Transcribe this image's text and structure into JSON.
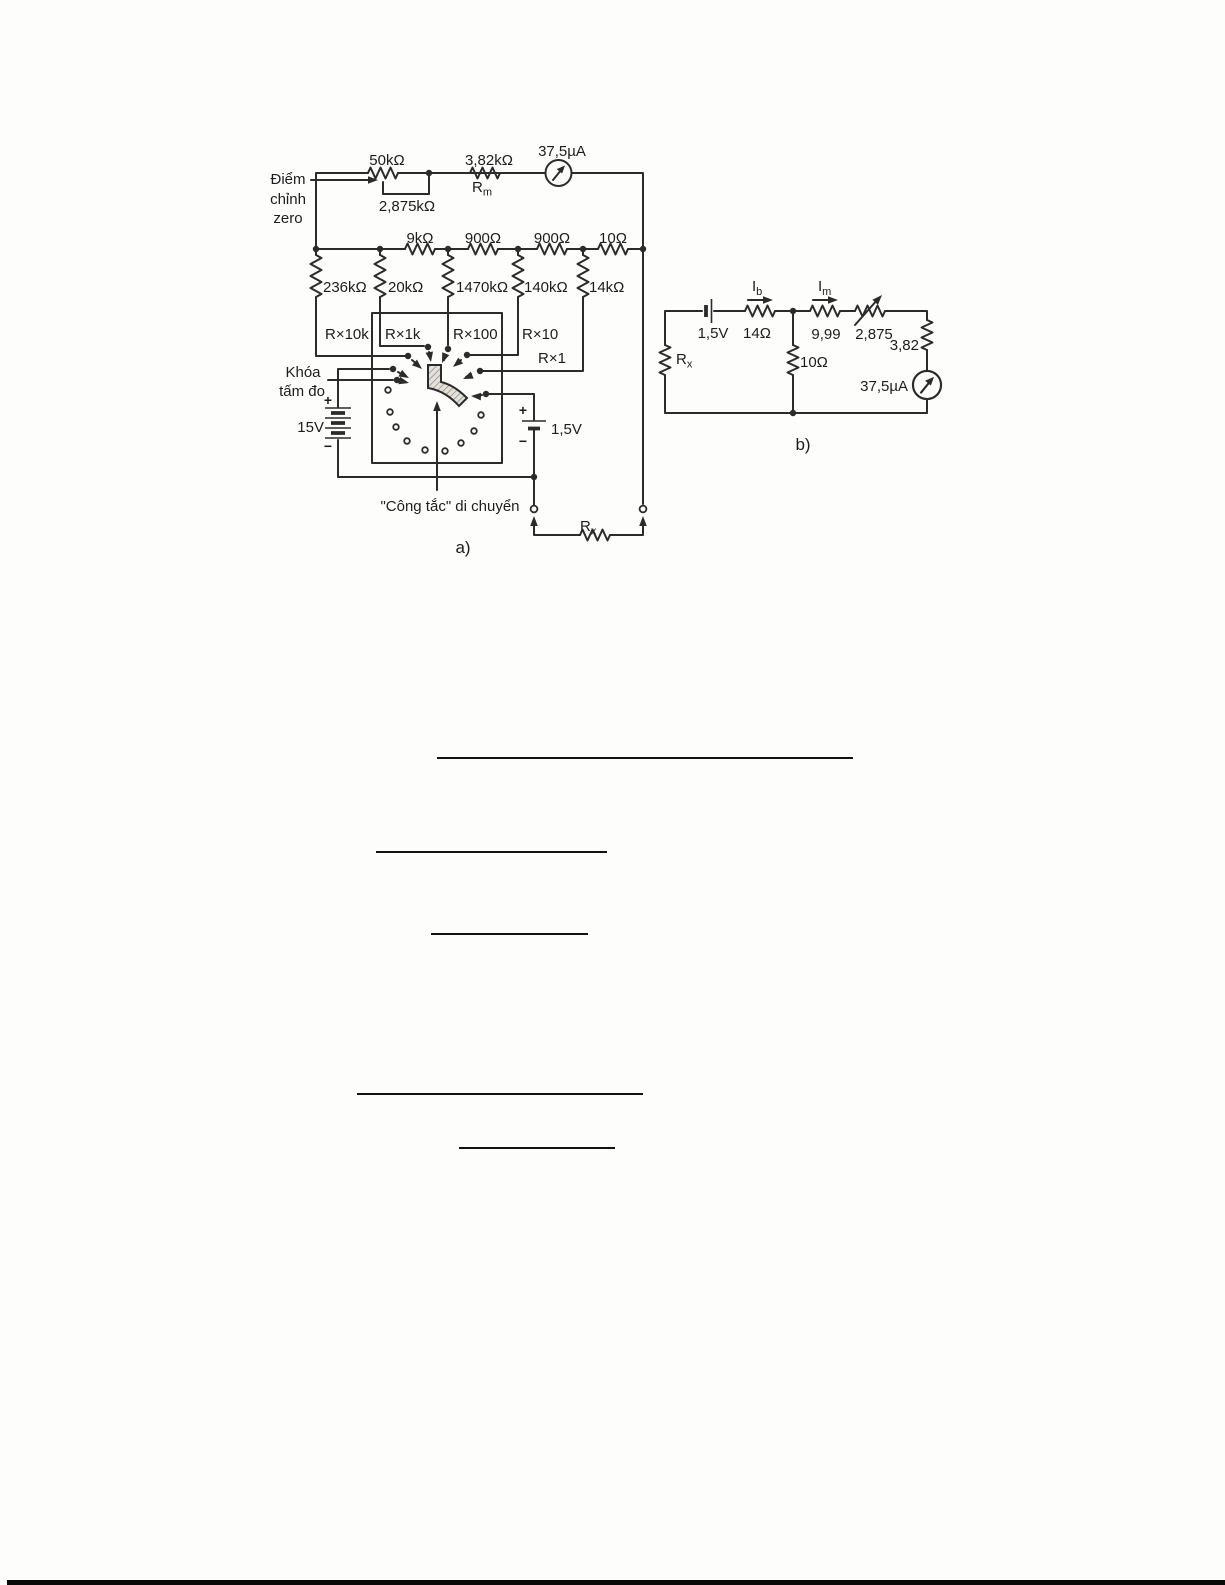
{
  "figure": {
    "circuit_a": {
      "caption": "a)",
      "zero_adjust": [
        "Điểm",
        "chỉnh",
        "zero"
      ],
      "pot": "50kΩ",
      "pot_shunt": "2,875kΩ",
      "rm_value": "3,82kΩ",
      "rm": {
        "base": "R",
        "sub": "m"
      },
      "meter": "37,5µA",
      "series": [
        "9kΩ",
        "900Ω",
        "900Ω",
        "10Ω"
      ],
      "shunts": [
        "236kΩ",
        "20kΩ",
        "1470kΩ",
        "140kΩ",
        "14kΩ"
      ],
      "ranges": [
        "R×10k",
        "R×1k",
        "R×100",
        "R×10",
        "R×1"
      ],
      "lock": [
        "Khóa",
        "tấm đo"
      ],
      "bat15": "15V",
      "bat15_plus": "+",
      "bat15_minus": "−",
      "bat1v5": "1,5V",
      "bat1v5_plus": "+",
      "bat1v5_minus": "−",
      "moving_switch": "\"Công tắc\" di chuyển",
      "rx": {
        "base": "R",
        "sub": "x"
      }
    },
    "circuit_b": {
      "caption": "b)",
      "bat": "1,5V",
      "ib": {
        "base": "I",
        "sub": "b"
      },
      "im": {
        "base": "I",
        "sub": "m"
      },
      "r_series": "14Ω",
      "r_999": "9,99",
      "r_2875": "2,875",
      "r_382": "3,82",
      "r_shunt": "10Ω",
      "meter": "37,5µA",
      "rx": {
        "base": "R",
        "sub": "x"
      }
    },
    "ink_color": "#2b2b2b"
  }
}
